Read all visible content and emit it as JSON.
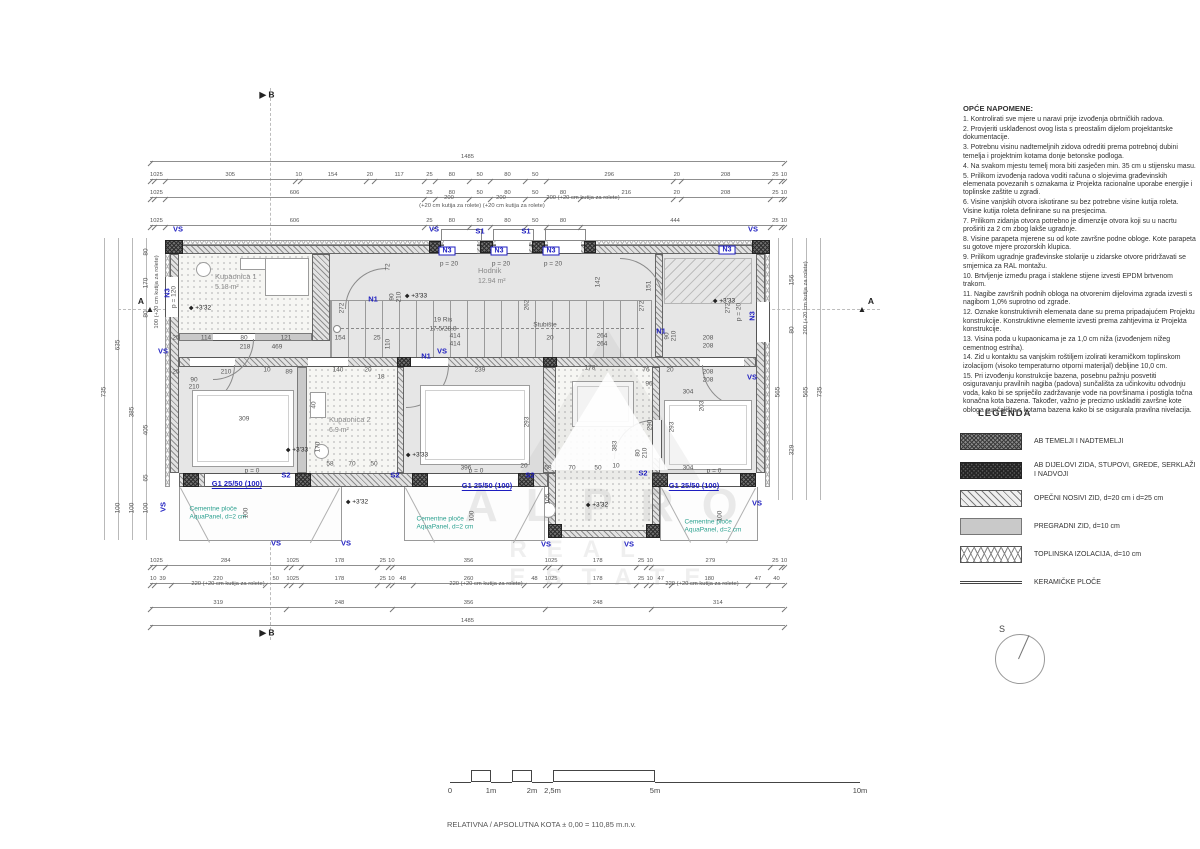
{
  "rooms": {
    "kupaonica1": {
      "name": "Kupaonica 1",
      "area": "5.18 m²"
    },
    "hodnik": {
      "name": "Hodnik",
      "area": "12.94 m²"
    },
    "stubiste": {
      "name": "Stubište",
      "risers": "19 Ris",
      "riser_dim": "17.5/28.8"
    },
    "spavaca1": {
      "name": "Spavaća soba 1",
      "area": "16.13 m²"
    },
    "kupaonica2": {
      "name": "Kupaonica 2",
      "area": "6.9 m²"
    },
    "spavaca2": {
      "name": "Spavaća soba 2",
      "area": "11.6 m²"
    },
    "kupaonica3": {
      "name": "Kupaonica 3",
      "area": "7.0 m²"
    },
    "spavaca3": {
      "name": "Spavaća soba 3",
      "area": "14.58 m²"
    }
  },
  "notes": {
    "title": "OPĆE NAPOMENE:",
    "items": [
      "1.   Kontrolirati sve mjere u naravi prije izvođenja obrtničkih radova.",
      "2.   Provjeriti usklađenost ovog lista s preostalim dijelom projektantske dokumentacije.",
      "3.   Potrebnu visinu nadtemeljnih zidova odrediti prema potrebnoj dubini temelja i projektnim kotama donje betonske podloga.",
      "4.   Na svakom mjestu temelj mora biti zasječen min. 35 cm  u stijensku masu.",
      "5.   Prilikom izvođenja radova voditi računa o slojevima građevinskih elemenata povezanih s oznakama iz Projekta racionalne uporabe energije i toplinske zaštite u zgradi.",
      "6.   Visine vanjskih otvora iskotirane su bez potrebne visine kutija roleta. Visine kutija roleta definirane su na presjecima.",
      "7.   Prilikom zidanja otvora potrebno je dimenzije otvora koji su u nacrtu proširiti za 2 cm zbog lakše ugradnje.",
      "8.   Visine parapeta mjerene su od kote završne podne obloge. Kote parapeta su gotove mjere prozorskih klupica.",
      "9.   Prilikom ugradnje građevinske stolarije u zidarske otvore pridržavati se smjernica za RAL montažu.",
      "10. Brtvljenje između praga i staklene stijene izvesti EPDM brtvenom trakom.",
      "11. Nagibe završnih podnih obloga na otvorenim dijelovima zgrada izvesti s nagibom 1,0% suprotno od zgrade.",
      "12. Oznake konstruktivnih elemenata dane su prema pripadajućem Projektu konstrukcije. Konstruktivne elemente izvesti prema zahtjevima iz Projekta konstrukcije.",
      "13. Visina poda u kupaonicama je za 1,0 cm niža (izvođenjem nižeg cementnog estriha).",
      "14. Zid u kontaktu sa vanjskim roštiljem izolirati keramičkom toplinskom izolacijom (visoko temperaturno otporni materijal) debljine 10,0 cm.",
      "15. Pri izvođenju konstrukcije bazena, posebnu pažnju posvetiti osiguravanju pravilnih nagiba (padova) sunčališta za učinkovitu odvodnju voda, kako bi se spriječilo zadržavanje vode na površinama i postigla točna konačna kota bazena. Također, važno je precizno uskladiti završne kote obloga sunčališta s kotama bazena kako bi se osigurala pravilna nivelacija."
    ]
  },
  "legend": {
    "title": "LEGENDA",
    "items": [
      {
        "swatch": "sw-ab1",
        "label": "AB TEMELJI I NADTEMELJI"
      },
      {
        "swatch": "sw-ab2",
        "label": "AB DIJELOVI ZIDA, STUPOVI, GREDE, SERKLAŽI I NADVOJI"
      },
      {
        "swatch": "sw-brick",
        "label": "OPEČNI NOSIVI ZID, d=20 cm i d=25 cm"
      },
      {
        "swatch": "sw-part",
        "label": "PREGRADNI ZID, d=10 cm"
      },
      {
        "swatch": "sw-ins",
        "label": "TOPLINSKA IZOLACIJA, d=10 cm"
      },
      {
        "swatch": "sw-cer",
        "label": "KERAMIČKE PLOČE"
      }
    ]
  },
  "north": {
    "label": "S"
  },
  "kota_line": "RELATIVNA / APSOLUTNA KOTA  ± 0,00 = 110,85 m.n.v.",
  "scalebar": {
    "ticks": [
      {
        "t": "0",
        "m": 0
      },
      {
        "t": "1m",
        "m": 1
      },
      {
        "t": "2m",
        "m": 2
      },
      {
        "t": "2,5m",
        "m": 2.5
      },
      {
        "t": "5m",
        "m": 5
      },
      {
        "t": "10m",
        "m": 10
      }
    ],
    "steps": [
      {
        "a": 0,
        "b": 0.5,
        "hi": false
      },
      {
        "a": 0.5,
        "b": 1,
        "hi": true
      },
      {
        "a": 1,
        "b": 1.5,
        "hi": false
      },
      {
        "a": 1.5,
        "b": 2,
        "hi": true
      },
      {
        "a": 2,
        "b": 2.5,
        "hi": false
      },
      {
        "a": 2.5,
        "b": 5,
        "hi": true
      },
      {
        "a": 5,
        "b": 10,
        "hi": false
      }
    ]
  },
  "watermark": {
    "line1": "ALPRO",
    "line2": "REAL ESTATE"
  },
  "dim_chains": [
    {
      "x": 150,
      "y": 152,
      "w": 635,
      "segs": [
        "1485"
      ]
    },
    {
      "x": 150,
      "y": 170,
      "w": 635,
      "segs": [
        "10",
        "25",
        "305",
        "10",
        "154",
        "20",
        "117",
        "25",
        "80",
        "50",
        "80",
        "50",
        "296",
        "20",
        "208",
        "25",
        "10"
      ]
    },
    {
      "x": 150,
      "y": 188,
      "w": 635,
      "segs": [
        "10",
        "25",
        "606",
        "25",
        "80",
        "50",
        "80",
        "50",
        "80",
        "216",
        "20",
        "208",
        "25",
        "10"
      ]
    },
    {
      "x": 150,
      "y": 216,
      "w": 635,
      "segs": [
        "10",
        "25",
        "606",
        "25",
        "80",
        "50",
        "80",
        "50",
        "80",
        "444",
        "25",
        "10"
      ]
    },
    {
      "x": 150,
      "y": 556,
      "w": 635,
      "segs": [
        "10",
        "25",
        "284",
        "10",
        "25",
        "178",
        "25",
        "10",
        "356",
        "10",
        "25",
        "178",
        "25",
        "10",
        "279",
        "25",
        "10"
      ]
    },
    {
      "x": 150,
      "y": 574,
      "w": 635,
      "segs": [
        "10",
        "39",
        "220",
        "50",
        "10",
        "25",
        "178",
        "25",
        "10",
        "48",
        "260",
        "48",
        "10",
        "25",
        "178",
        "25",
        "10",
        "47",
        "180",
        "47",
        "40"
      ]
    },
    {
      "x": 150,
      "y": 598,
      "w": 635,
      "segs": [
        "319",
        "248",
        "356",
        "248",
        "314"
      ]
    },
    {
      "x": 150,
      "y": 616,
      "w": 635,
      "segs": [
        "1485"
      ]
    }
  ],
  "guides": [
    {
      "x": 104,
      "y": 238,
      "h": 302
    },
    {
      "x": 118,
      "y": 238,
      "h": 302
    },
    {
      "x": 132,
      "y": 238,
      "h": 302
    },
    {
      "x": 146,
      "y": 238,
      "h": 302
    },
    {
      "x": 778,
      "y": 238,
      "h": 262
    },
    {
      "x": 792,
      "y": 238,
      "h": 262
    },
    {
      "x": 806,
      "y": 238,
      "h": 262
    },
    {
      "x": 820,
      "y": 238,
      "h": 262
    }
  ],
  "annotations": [
    {
      "t": "VS",
      "x": 178,
      "y": 229,
      "c": "blue"
    },
    {
      "t": "VS",
      "x": 434,
      "y": 229,
      "c": "blue"
    },
    {
      "t": "VS",
      "x": 753,
      "y": 229,
      "c": "blue"
    },
    {
      "t": "S1",
      "x": 480,
      "y": 231,
      "c": "blue"
    },
    {
      "t": "S1",
      "x": 526,
      "y": 231,
      "c": "blue"
    },
    {
      "t": "N3",
      "x": 447,
      "y": 251,
      "c": "bluebox"
    },
    {
      "t": "N3",
      "x": 499,
      "y": 251,
      "c": "bluebox"
    },
    {
      "t": "N3",
      "x": 551,
      "y": 251,
      "c": "bluebox"
    },
    {
      "t": "N3",
      "x": 727,
      "y": 250,
      "c": "bluebox"
    },
    {
      "t": "N3",
      "x": 167,
      "y": 293,
      "c": "blue",
      "r": -90
    },
    {
      "t": "N3",
      "x": 752,
      "y": 316,
      "c": "blue",
      "r": -90
    },
    {
      "t": "N1",
      "x": 373,
      "y": 299,
      "c": "blue"
    },
    {
      "t": "N1",
      "x": 426,
      "y": 356,
      "c": "blue"
    },
    {
      "t": "N1",
      "x": 661,
      "y": 331,
      "c": "blue"
    },
    {
      "t": "VS",
      "x": 442,
      "y": 351,
      "c": "blue"
    },
    {
      "t": "VS",
      "x": 752,
      "y": 377,
      "c": "blue"
    },
    {
      "t": "VS",
      "x": 163,
      "y": 351,
      "c": "blue"
    },
    {
      "t": "S2",
      "x": 286,
      "y": 475,
      "c": "blue"
    },
    {
      "t": "S2",
      "x": 395,
      "y": 475,
      "c": "blue"
    },
    {
      "t": "S2",
      "x": 530,
      "y": 475,
      "c": "blue"
    },
    {
      "t": "S2",
      "x": 643,
      "y": 473,
      "c": "blue"
    },
    {
      "t": "G1 25/50 (100)",
      "x": 237,
      "y": 484,
      "c": "blueu"
    },
    {
      "t": "G1 25/50 (100)",
      "x": 487,
      "y": 486,
      "c": "blueu"
    },
    {
      "t": "G1 25/50 (100)",
      "x": 694,
      "y": 486,
      "c": "blueu"
    },
    {
      "t": "VS",
      "x": 276,
      "y": 543,
      "c": "blue"
    },
    {
      "t": "VS",
      "x": 346,
      "y": 543,
      "c": "blue"
    },
    {
      "t": "VS",
      "x": 546,
      "y": 544,
      "c": "blue"
    },
    {
      "t": "VS",
      "x": 629,
      "y": 544,
      "c": "blue"
    },
    {
      "t": "VS",
      "x": 163,
      "y": 507,
      "c": "blue",
      "r": -90
    },
    {
      "t": "VS",
      "x": 757,
      "y": 503,
      "c": "blue"
    },
    {
      "t": "Cementne ploče\nAquaPanel, d=2 cm",
      "x": 218,
      "y": 514,
      "c": "teal"
    },
    {
      "t": "Cementne ploče\nAquaPanel, d=2 cm",
      "x": 445,
      "y": 524,
      "c": "teal"
    },
    {
      "t": "Cementne ploče\nAquaPanel, d=2 cm",
      "x": 713,
      "y": 527,
      "c": "teal"
    },
    {
      "t": "+3'32",
      "x": 200,
      "y": 308,
      "c": "lvl"
    },
    {
      "t": "+3'33",
      "x": 416,
      "y": 296,
      "c": "lvl"
    },
    {
      "t": "+3'33",
      "x": 724,
      "y": 301,
      "c": "lvl"
    },
    {
      "t": "+3'33",
      "x": 297,
      "y": 450,
      "c": "lvl"
    },
    {
      "t": "+3'33",
      "x": 417,
      "y": 455,
      "c": "lvl"
    },
    {
      "t": "+3'32",
      "x": 357,
      "y": 502,
      "c": "lvl"
    },
    {
      "t": "+3'32",
      "x": 597,
      "y": 505,
      "c": "lvl"
    },
    {
      "t": "p = 120",
      "x": 174,
      "y": 297,
      "c": "dim",
      "r": -90
    },
    {
      "t": "p = 20",
      "x": 449,
      "y": 264,
      "c": "dim"
    },
    {
      "t": "p = 20",
      "x": 501,
      "y": 264,
      "c": "dim"
    },
    {
      "t": "p = 20",
      "x": 553,
      "y": 264,
      "c": "dim"
    },
    {
      "t": "p = 20",
      "x": 739,
      "y": 312,
      "c": "dim",
      "r": -90
    },
    {
      "t": "p = 0",
      "x": 252,
      "y": 471,
      "c": "dim"
    },
    {
      "t": "p = 0",
      "x": 476,
      "y": 471,
      "c": "dim"
    },
    {
      "t": "p = 0",
      "x": 714,
      "y": 471,
      "c": "dim"
    },
    {
      "t": "A",
      "x": 141,
      "y": 301,
      "c": "sec"
    },
    {
      "t": "▲",
      "x": 150,
      "y": 309,
      "c": "sec"
    },
    {
      "t": "A",
      "x": 871,
      "y": 301,
      "c": "sec"
    },
    {
      "t": "▲",
      "x": 862,
      "y": 309,
      "c": "sec"
    },
    {
      "t": "▶ B",
      "x": 267,
      "y": 95,
      "c": "sec"
    },
    {
      "t": "▶ B",
      "x": 267,
      "y": 633,
      "c": "sec"
    },
    {
      "t": "200",
      "x": 449,
      "y": 198,
      "c": "sub"
    },
    {
      "t": "200",
      "x": 501,
      "y": 198,
      "c": "sub"
    },
    {
      "t": "200 (+20 cm kutija za rolete)",
      "x": 583,
      "y": 198,
      "c": "sub"
    },
    {
      "t": "(+20 cm kutija za rolete) (+20 cm kutija za rolete)",
      "x": 482,
      "y": 206,
      "c": "sub"
    },
    {
      "t": "220 (+20 cm kutija za rolete)",
      "x": 228,
      "y": 584,
      "c": "sub"
    },
    {
      "t": "220 (+20 cm kutija za rolete)",
      "x": 486,
      "y": 584,
      "c": "sub"
    },
    {
      "t": "220 (+20 cm kutija za rolete)",
      "x": 702,
      "y": 584,
      "c": "sub"
    },
    {
      "t": "735",
      "x": 104,
      "y": 392,
      "c": "dim",
      "r": -90
    },
    {
      "t": "635",
      "x": 118,
      "y": 345,
      "c": "dim",
      "r": -90
    },
    {
      "t": "100",
      "x": 118,
      "y": 508,
      "c": "dim",
      "r": -90
    },
    {
      "t": "385",
      "x": 132,
      "y": 412,
      "c": "dim",
      "r": -90
    },
    {
      "t": "100",
      "x": 132,
      "y": 508,
      "c": "dim",
      "r": -90
    },
    {
      "t": "405",
      "x": 146,
      "y": 430,
      "c": "dim",
      "r": -90
    },
    {
      "t": "65",
      "x": 146,
      "y": 478,
      "c": "dim",
      "r": -90
    },
    {
      "t": "100",
      "x": 146,
      "y": 508,
      "c": "dim",
      "r": -90
    },
    {
      "t": "80",
      "x": 146,
      "y": 252,
      "c": "dim",
      "r": -90
    },
    {
      "t": "170",
      "x": 146,
      "y": 283,
      "c": "dim",
      "r": -90
    },
    {
      "t": "80",
      "x": 146,
      "y": 314,
      "c": "dim",
      "r": -90
    },
    {
      "t": "100 (+20 cm kutija za rolete)",
      "x": 157,
      "y": 292,
      "c": "sub",
      "r": -90
    },
    {
      "t": "156",
      "x": 792,
      "y": 280,
      "c": "dim",
      "r": -90
    },
    {
      "t": "80",
      "x": 792,
      "y": 330,
      "c": "dim",
      "r": -90
    },
    {
      "t": "329",
      "x": 792,
      "y": 450,
      "c": "dim",
      "r": -90
    },
    {
      "t": "565",
      "x": 778,
      "y": 392,
      "c": "dim",
      "r": -90
    },
    {
      "t": "565",
      "x": 806,
      "y": 392,
      "c": "dim",
      "r": -90
    },
    {
      "t": "200 (+20 cm kutija za rolete)",
      "x": 806,
      "y": 298,
      "c": "sub",
      "r": -90
    },
    {
      "t": "735",
      "x": 820,
      "y": 392,
      "c": "dim",
      "r": -90
    },
    {
      "t": "25",
      "x": 176,
      "y": 338,
      "c": "dim"
    },
    {
      "t": "114",
      "x": 206,
      "y": 338,
      "c": "dim"
    },
    {
      "t": "80",
      "x": 244,
      "y": 338,
      "c": "dim"
    },
    {
      "t": "121",
      "x": 286,
      "y": 338,
      "c": "dim"
    },
    {
      "t": "154",
      "x": 340,
      "y": 338,
      "c": "dim"
    },
    {
      "t": "25",
      "x": 377,
      "y": 338,
      "c": "dim"
    },
    {
      "t": "218",
      "x": 245,
      "y": 347,
      "c": "dim"
    },
    {
      "t": "469",
      "x": 277,
      "y": 347,
      "c": "dim"
    },
    {
      "t": "110",
      "x": 388,
      "y": 344,
      "c": "dim",
      "r": -90
    },
    {
      "t": "25",
      "x": 176,
      "y": 372,
      "c": "dim"
    },
    {
      "t": "210",
      "x": 226,
      "y": 372,
      "c": "dim"
    },
    {
      "t": "10",
      "x": 267,
      "y": 370,
      "c": "dim"
    },
    {
      "t": "89",
      "x": 289,
      "y": 372,
      "c": "dim"
    },
    {
      "t": "140",
      "x": 338,
      "y": 370,
      "c": "dim"
    },
    {
      "t": "20",
      "x": 368,
      "y": 370,
      "c": "dim"
    },
    {
      "t": "18",
      "x": 381,
      "y": 377,
      "c": "dim"
    },
    {
      "t": "90",
      "x": 194,
      "y": 380,
      "c": "dim"
    },
    {
      "t": "210",
      "x": 194,
      "y": 387,
      "c": "dim"
    },
    {
      "t": "272",
      "x": 342,
      "y": 308,
      "c": "dim",
      "r": -90
    },
    {
      "t": "72",
      "x": 388,
      "y": 267,
      "c": "dim",
      "r": -90
    },
    {
      "t": "262",
      "x": 527,
      "y": 305,
      "c": "dim",
      "r": -90
    },
    {
      "t": "142",
      "x": 598,
      "y": 282,
      "c": "dim",
      "r": -90
    },
    {
      "t": "151",
      "x": 649,
      "y": 286,
      "c": "dim",
      "r": -90
    },
    {
      "t": "272",
      "x": 642,
      "y": 306,
      "c": "dim",
      "r": -90
    },
    {
      "t": "272",
      "x": 728,
      "y": 308,
      "c": "dim",
      "r": -90
    },
    {
      "t": "414",
      "x": 455,
      "y": 336,
      "c": "dim"
    },
    {
      "t": "414",
      "x": 455,
      "y": 344,
      "c": "dim"
    },
    {
      "t": "20",
      "x": 550,
      "y": 338,
      "c": "dim"
    },
    {
      "t": "264",
      "x": 602,
      "y": 336,
      "c": "dim"
    },
    {
      "t": "264",
      "x": 602,
      "y": 344,
      "c": "dim"
    },
    {
      "t": "90",
      "x": 392,
      "y": 297,
      "c": "dim",
      "r": -90
    },
    {
      "t": "210",
      "x": 399,
      "y": 297,
      "c": "dim",
      "r": -90
    },
    {
      "t": "90",
      "x": 667,
      "y": 336,
      "c": "dim",
      "r": -90
    },
    {
      "t": "210",
      "x": 674,
      "y": 336,
      "c": "dim",
      "r": -90
    },
    {
      "t": "239",
      "x": 480,
      "y": 370,
      "c": "dim"
    },
    {
      "t": "178",
      "x": 590,
      "y": 368,
      "c": "dim"
    },
    {
      "t": "76",
      "x": 646,
      "y": 370,
      "c": "dim"
    },
    {
      "t": "20",
      "x": 670,
      "y": 370,
      "c": "dim"
    },
    {
      "t": "96",
      "x": 649,
      "y": 384,
      "c": "dim"
    },
    {
      "t": "304",
      "x": 688,
      "y": 392,
      "c": "dim"
    },
    {
      "t": "304",
      "x": 688,
      "y": 468,
      "c": "dim"
    },
    {
      "t": "208",
      "x": 708,
      "y": 338,
      "c": "dim"
    },
    {
      "t": "208",
      "x": 708,
      "y": 346,
      "c": "dim"
    },
    {
      "t": "208",
      "x": 708,
      "y": 372,
      "c": "dim"
    },
    {
      "t": "208",
      "x": 708,
      "y": 380,
      "c": "dim"
    },
    {
      "t": "293",
      "x": 527,
      "y": 422,
      "c": "dim",
      "r": -90
    },
    {
      "t": "290",
      "x": 650,
      "y": 425,
      "c": "dim",
      "r": -90
    },
    {
      "t": "293",
      "x": 672,
      "y": 427,
      "c": "dim",
      "r": -90
    },
    {
      "t": "203",
      "x": 702,
      "y": 406,
      "c": "dim",
      "r": -90
    },
    {
      "t": "383",
      "x": 615,
      "y": 446,
      "c": "dim",
      "r": -90
    },
    {
      "t": "105",
      "x": 548,
      "y": 499,
      "c": "dim",
      "r": -90
    },
    {
      "t": "309",
      "x": 244,
      "y": 419,
      "c": "dim"
    },
    {
      "t": "396",
      "x": 466,
      "y": 468,
      "c": "dim"
    },
    {
      "t": "20",
      "x": 524,
      "y": 466,
      "c": "dim"
    },
    {
      "t": "58",
      "x": 548,
      "y": 468,
      "c": "dim"
    },
    {
      "t": "70",
      "x": 572,
      "y": 468,
      "c": "dim"
    },
    {
      "t": "50",
      "x": 598,
      "y": 468,
      "c": "dim"
    },
    {
      "t": "10",
      "x": 616,
      "y": 466,
      "c": "dim"
    },
    {
      "t": "58",
      "x": 330,
      "y": 464,
      "c": "dim"
    },
    {
      "t": "70",
      "x": 352,
      "y": 464,
      "c": "dim"
    },
    {
      "t": "50",
      "x": 374,
      "y": 464,
      "c": "dim"
    },
    {
      "t": "170",
      "x": 318,
      "y": 447,
      "c": "dim",
      "r": -90
    },
    {
      "t": "40",
      "x": 314,
      "y": 405,
      "c": "dim",
      "r": -90
    },
    {
      "t": "100",
      "x": 246,
      "y": 513,
      "c": "dim",
      "r": -90
    },
    {
      "t": "100",
      "x": 472,
      "y": 516,
      "c": "dim",
      "r": -90
    },
    {
      "t": "100",
      "x": 720,
      "y": 516,
      "c": "dim",
      "r": -90
    },
    {
      "t": "80",
      "x": 638,
      "y": 453,
      "c": "dim",
      "r": -90
    },
    {
      "t": "210",
      "x": 645,
      "y": 453,
      "c": "dim",
      "r": -90
    }
  ]
}
